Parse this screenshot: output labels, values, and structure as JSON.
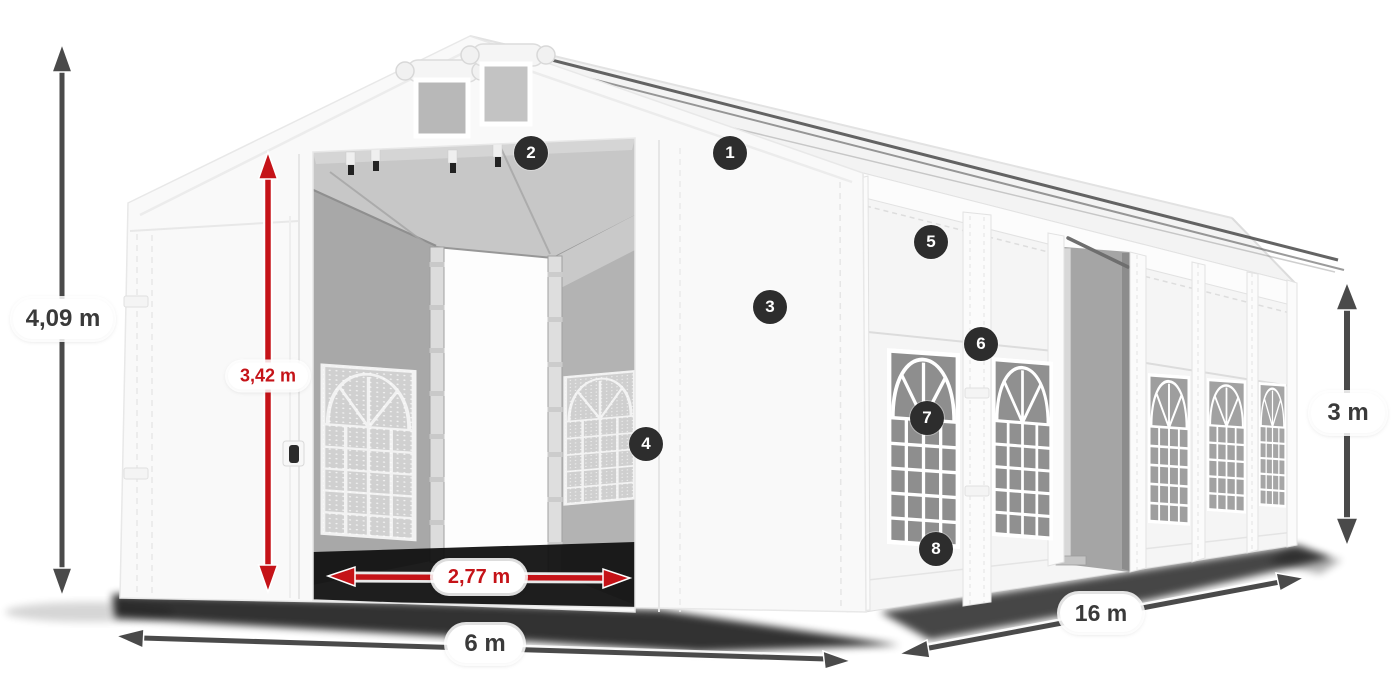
{
  "dimensions": {
    "total_height": {
      "label": "4,09 m",
      "style": "dark"
    },
    "inner_height": {
      "label": "3,42 m",
      "style": "red"
    },
    "entrance_width": {
      "label": "2,77 m",
      "style": "red"
    },
    "width": {
      "label": "6 m",
      "style": "dark"
    },
    "length": {
      "label": "16 m",
      "style": "dark"
    },
    "side_height": {
      "label": "3 m",
      "style": "dark"
    }
  },
  "callouts": [
    {
      "number": "1"
    },
    {
      "number": "2"
    },
    {
      "number": "3"
    },
    {
      "number": "4"
    },
    {
      "number": "5"
    },
    {
      "number": "6"
    },
    {
      "number": "7"
    },
    {
      "number": "8"
    }
  ],
  "colors": {
    "background": "#ffffff",
    "dimension_text_dark": "#3a3a3a",
    "dimension_text_red": "#c51318",
    "arrow_dark": "#4a4a4a",
    "arrow_red": "#c51318",
    "callout_background": "#2d2d2d",
    "callout_text": "#ffffff",
    "tent_white": "#f9f9f9",
    "interior_gray": "#a8a8a8"
  }
}
